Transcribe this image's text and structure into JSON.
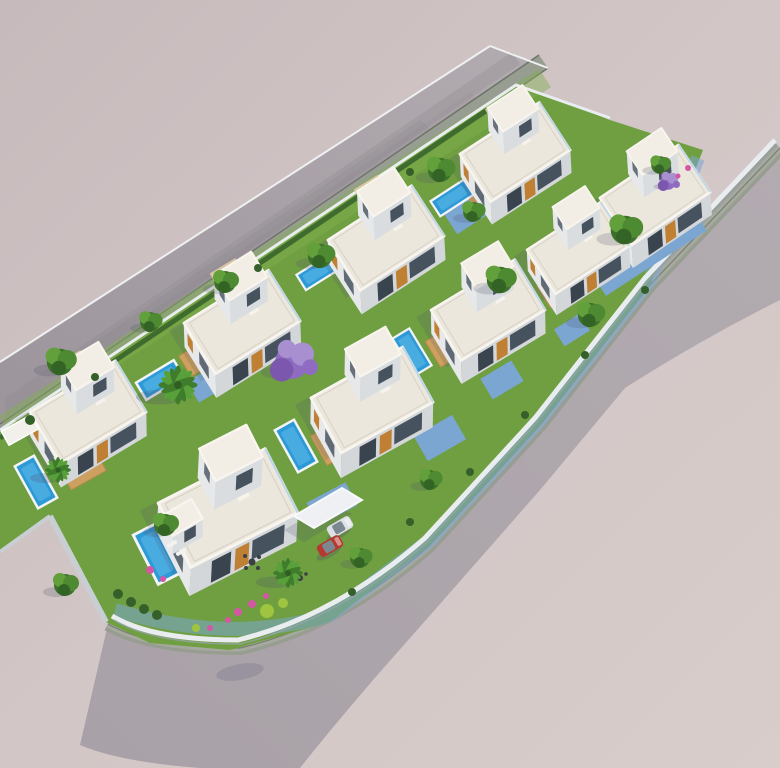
{
  "scene": {
    "description": "Aerial 3D architectural rendering of a modern seaside villa development: nine white flat-roofed two-storey villas with timber accents arranged in two staggered rows on a diagonal landscaped block, each with private swimming pool, timber deck and lawn, bounded by an upper dead-end road and a lower curved perimeter road, with palm trees, a purple flowering tree, pink bougainvillea, a carport and two parked cars (one silver, one red) on bare pink-grey ground",
    "view": "isometric aerial view from south-east",
    "setting": "empty pink-grey terrain, no text or UI elements visible",
    "counts": {
      "villas": 9,
      "swimming_pools": 9,
      "timber_decks": 9,
      "cars": 2,
      "carports": 1,
      "palm_trees": 3,
      "green_trees": 14,
      "purple_flowering_trees": 2,
      "roads": 2
    },
    "cars": [
      {
        "name": "silver-car",
        "color_name": "silver",
        "hex": "#dde1e5"
      },
      {
        "name": "red-car",
        "color_name": "red",
        "hex": "#b5392f"
      }
    ],
    "roads": [
      {
        "name": "upper-road",
        "form": "straight dead-end street running diagonally from upper centre to left edge, pale asphalt with grey-green sidewalk strip on its lower side"
      },
      {
        "name": "perimeter-road",
        "form": "road entering from right edge, running down along the block and curving around its lower-left corner to a squared dead end"
      }
    ],
    "landscaping": [
      "lawns",
      "hedges",
      "box shrubs",
      "lime-green ball bushes",
      "pink bougainvillea",
      "palm trees",
      "purple jacaranda-style tree"
    ],
    "pool_color_name": "bright azure blue",
    "paving_color_name": "blue-grey concrete terraces and driveways"
  },
  "palette": {
    "bg1": "#c6babc",
    "bg2": "#d2c6c6",
    "bg3": "#d9cdcb",
    "road1": "#b2abb0",
    "road2": "#9b949b",
    "road3": "#a8a1a7",
    "sidewalk": "#989d92",
    "sidewalk2": "#a6aa9e",
    "sidewalk-edge": "#6f746a",
    "curb": "#eef0f2",
    "lawn": "#6f9f41",
    "lawn-light": "#81b04f",
    "hedge": "#35602a",
    "roof": "#ece7dd",
    "roof-light": "#f2eee5",
    "parapet": "#f8f5ef",
    "wall-sw": "#e7e8ea",
    "wall-se": "#d4d7da",
    "wall-ne": "#dadde0",
    "glass": "#46535f",
    "glass-dark": "#39444f",
    "accent-wood": "#bf8034",
    "deck-wood": "#cda05f",
    "pool": "#2d9ad7",
    "pool-light": "#5ab9e8",
    "pool-rim": "#f2f4f6",
    "paving": "#7ba6d2",
    "tree-dark": "#3c7129",
    "tree-mid": "#4e8a31",
    "tree-light": "#61a03a",
    "lime": "#9fc43f",
    "palm1": "#3f7d2c",
    "palm2": "#58a03a",
    "purple1": "#8f6cc1",
    "purple2": "#a78fd0",
    "purple3": "#7b57ae",
    "flower": "#d457a4",
    "car-silver": "#dde1e5",
    "car-red": "#b5392f",
    "stone": "#c9ced3",
    "wall-white": "#e9edf0",
    "walkway": "#dbc9a4",
    "shadow": "#50506b"
  }
}
